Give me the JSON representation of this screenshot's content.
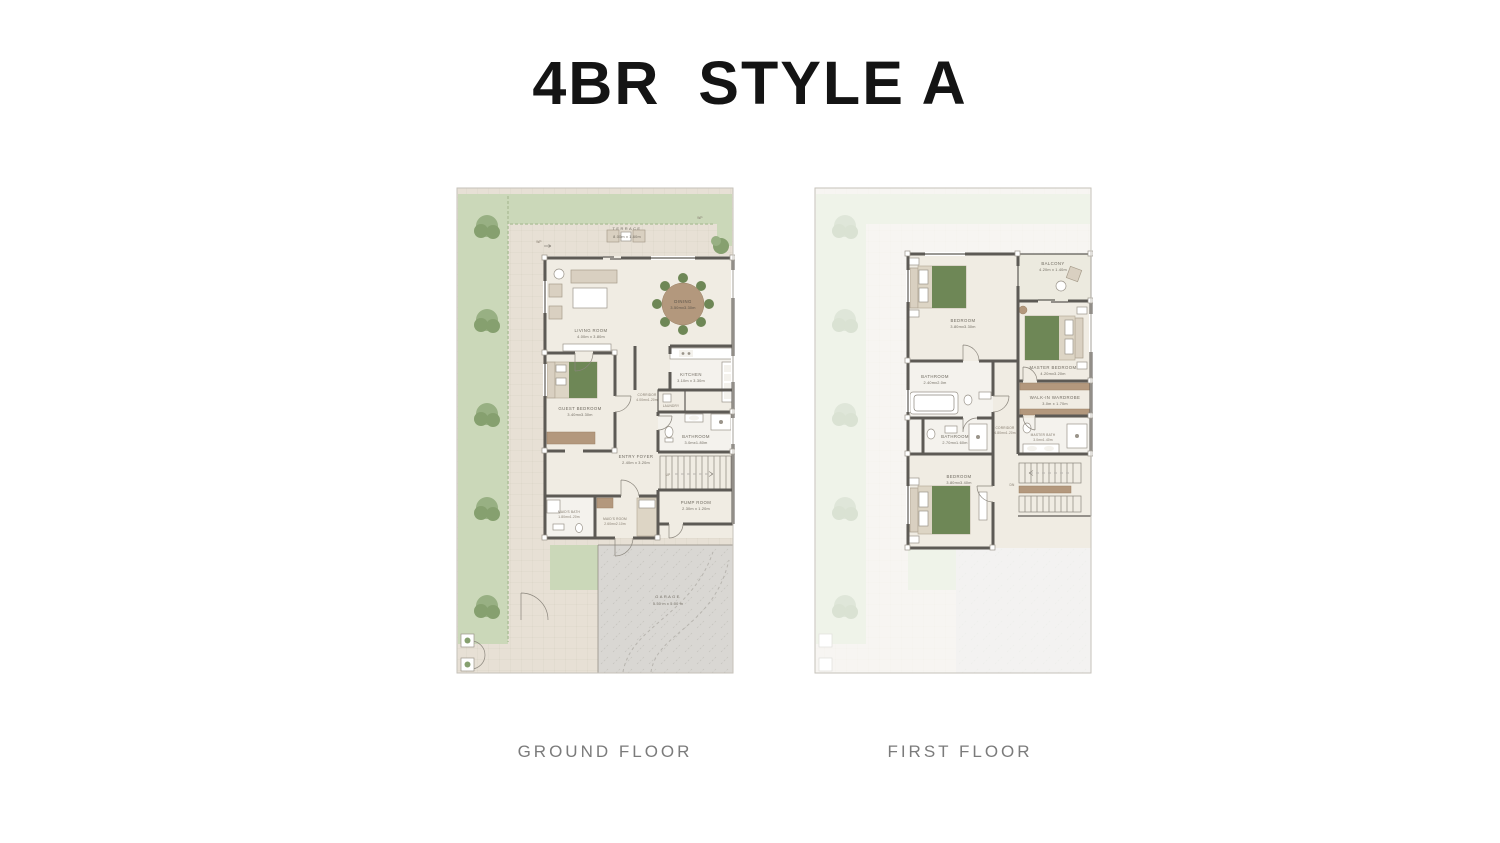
{
  "title": "4BR  STYLE A",
  "gf": {
    "caption": "GROUND FLOOR",
    "terrace": {
      "name": "TERRACE",
      "dims": "8.00m x 1.60m"
    },
    "living": {
      "name": "LIVING ROOM",
      "dims": "4.00m x 3.80m"
    },
    "dining": {
      "name": "DINING",
      "dims": "3.50mx3.30m"
    },
    "kitchen": {
      "name": "KITCHEN",
      "dims": "3.10m x 3.30m"
    },
    "corridor": {
      "name": "CORRIDOR",
      "dims": "4.00mx1.20m"
    },
    "laundry": {
      "name": "LAUNDRY"
    },
    "guest": {
      "name": "GUEST BEDROOM",
      "dims": "3.40mx3.30m"
    },
    "bath": {
      "name": "BATHROOM",
      "dims": "3.0mx1.80m"
    },
    "foyer": {
      "name": "ENTRY FOYER",
      "dims": "2.40m x 3.20m"
    },
    "maids_bath": {
      "name": "MAID'S BATH",
      "dims": "1.80mx1.20m"
    },
    "maids_room": {
      "name": "MAID'S ROOM",
      "dims": "2.60mx2.10m"
    },
    "pump": {
      "name": "PUMP ROOM",
      "dims": "2.30m x 1.20m"
    },
    "garage": {
      "name": "GARAGE",
      "dims": "5.50 m x 5.00 m"
    },
    "up": "UP",
    "wp": "WP"
  },
  "ff": {
    "caption": "FIRST FLOOR",
    "bedroom2": {
      "name": "BEDROOM",
      "dims": "3.80mx3.30m"
    },
    "balcony": {
      "name": "BALCONY",
      "dims": "4.20m x 1.40m"
    },
    "master": {
      "name": "MASTER BEDROOM",
      "dims": "4.20mx3.20m"
    },
    "bath_a": {
      "name": "BATHROOM",
      "dims": "2.40mx2.0m"
    },
    "bath_b": {
      "name": "BATHROOM",
      "dims": "2.70mx1.60m"
    },
    "wardrobe": {
      "name": "WALK-IN WARDROBE",
      "dims": "3.0m x 1.70m"
    },
    "corridor": {
      "name": "CORRIDOR",
      "dims": "4.80mx1.20m"
    },
    "master_bath": {
      "name": "MASTER BATH",
      "dims": "3.0mx1.40m"
    },
    "bedroom3": {
      "name": "BEDROOM",
      "dims": "3.80mx3.40m"
    },
    "dn": "DN"
  },
  "colors": {
    "title_ink": "#141414",
    "caption_ink": "#7b7b7b",
    "wall": "#5d5a55",
    "garden": "#cbd8b9",
    "tree": "#93ac80",
    "paving": "#e7e0d5",
    "floor": "#f0ece3",
    "tile": "#f4f2ed",
    "furn": "#d9d0c1",
    "wood": "#b3987d",
    "bed_green": "#6e8756",
    "garage": "#d9d7d3",
    "label_ink": "#6f6a60",
    "plot_line": "#c6c2ba"
  }
}
